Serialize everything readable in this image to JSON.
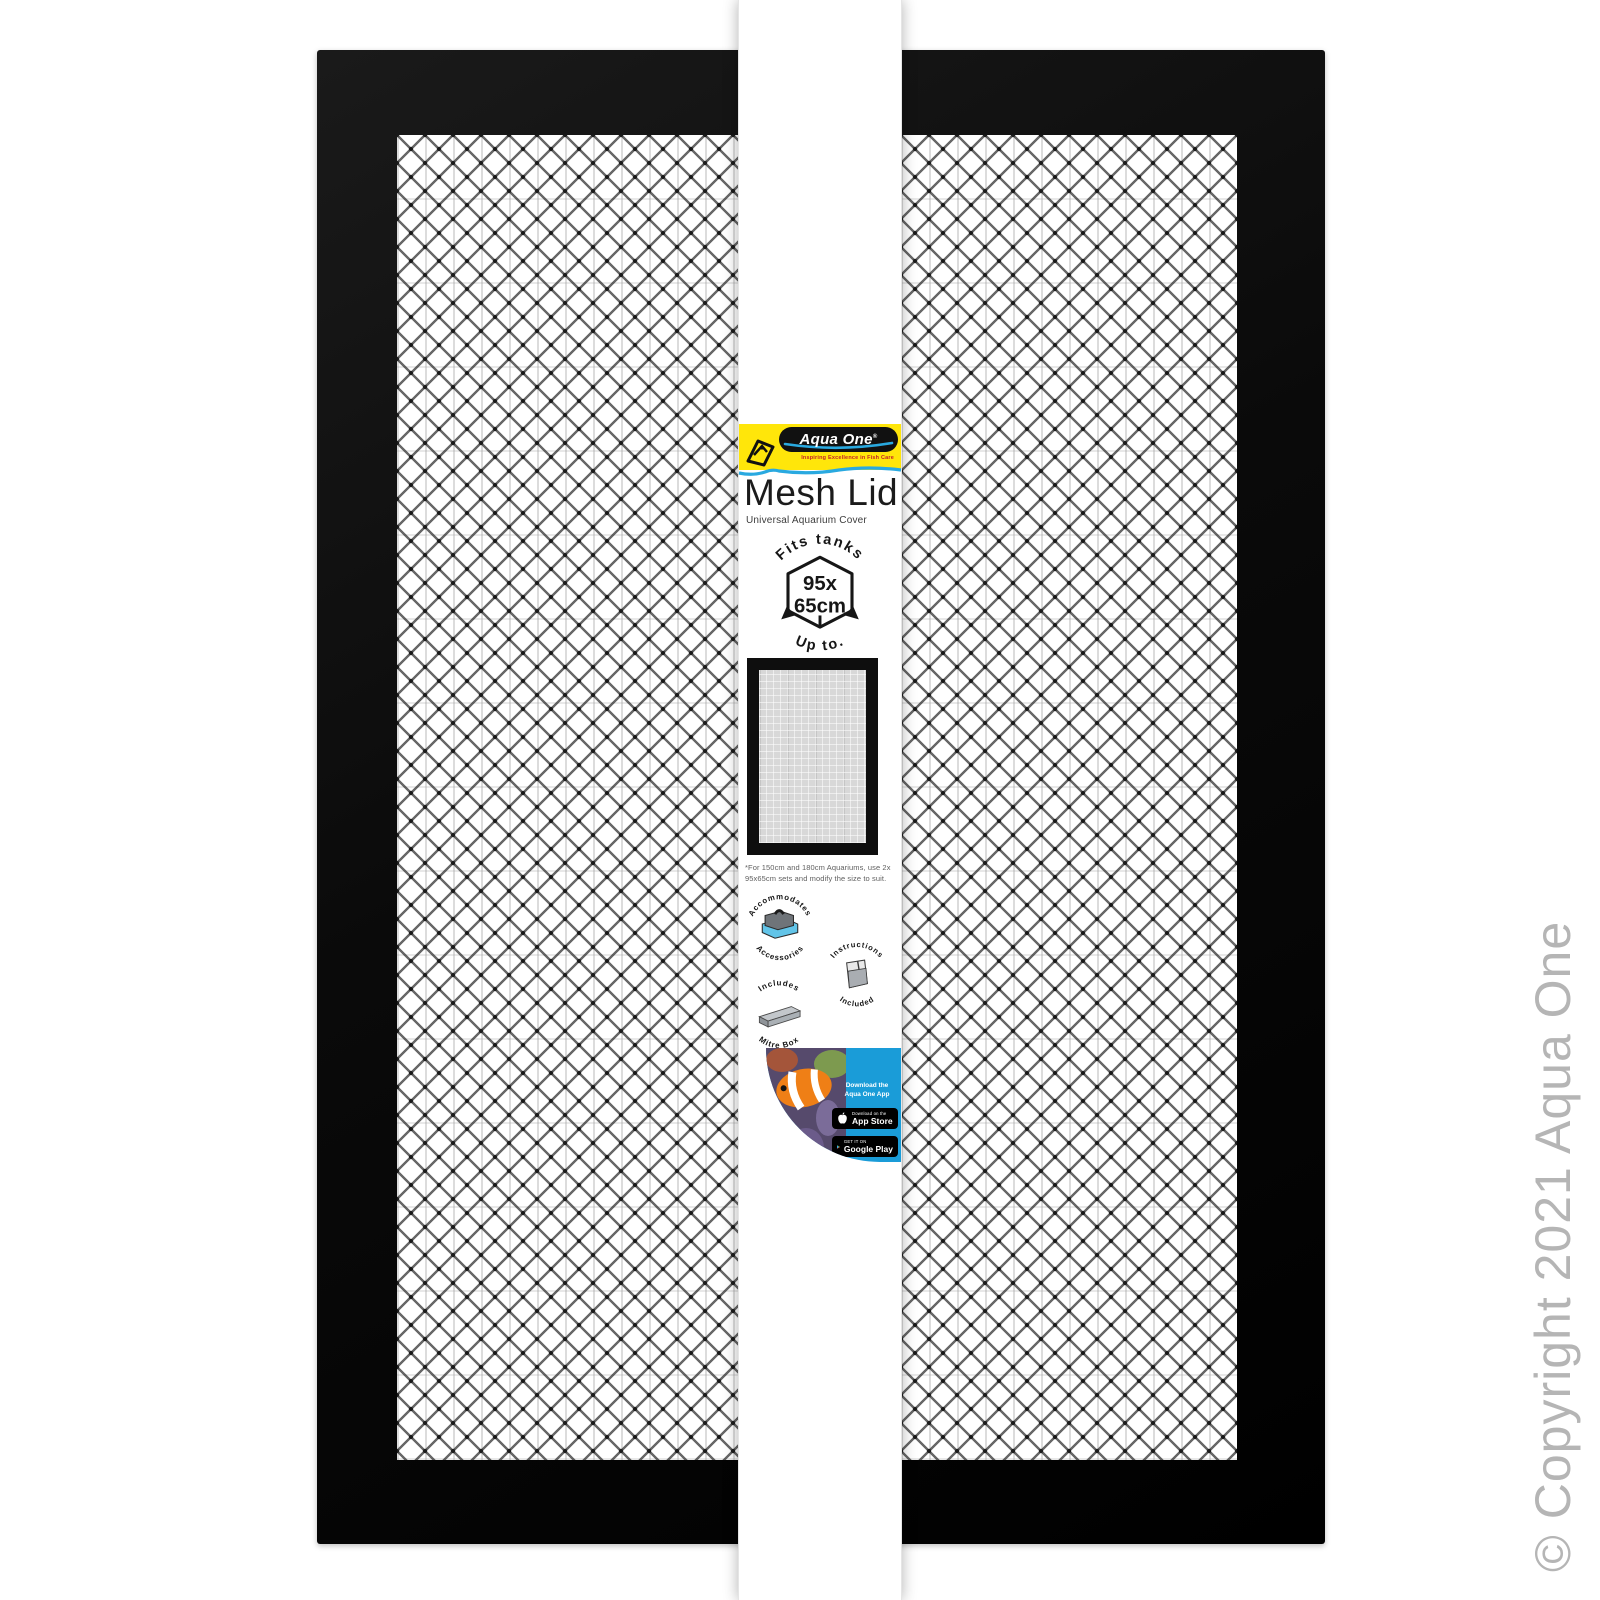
{
  "brand": {
    "name": "Aqua One",
    "registered_mark": "®",
    "tagline": "Inspiring Excellence in Fish Care"
  },
  "product": {
    "title": "Mesh Lid",
    "subtitle": "Universal Aquarium Cover",
    "fits_badge": {
      "arc_top": "Fits tanks",
      "arc_bottom": "Up to.",
      "size_line1": "95x",
      "size_line2": "65cm"
    },
    "fine_print": {
      "line1": "*For 150cm and 180cm Aquariums, use 2x",
      "line2": "95x65cm sets and modify the size to suit."
    },
    "feature_badges": [
      {
        "arc_top": "Accommodates",
        "arc_bottom": "Accessories"
      },
      {
        "arc_top": "Instructions",
        "arc_bottom": "Included"
      },
      {
        "arc_top": "Includes",
        "arc_bottom": "Mitre Box"
      }
    ],
    "app_promo": {
      "line1": "Download the",
      "line2": "Aqua One App",
      "app_store_top": "Download on the",
      "app_store_bottom": "App Store",
      "google_play_top": "GET IT ON",
      "google_play_bottom": "Google Play"
    }
  },
  "watermark": "© Copyright 2021 Aqua One",
  "colors": {
    "brand_yellow": "#ffe60a",
    "brand_blue": "#29a9e0",
    "tagline_red": "#c3202a",
    "frame_black": "#0d0d0d",
    "app_panel_blue": "#1a9cd8",
    "watermark_gray": "#b5b5b5"
  }
}
